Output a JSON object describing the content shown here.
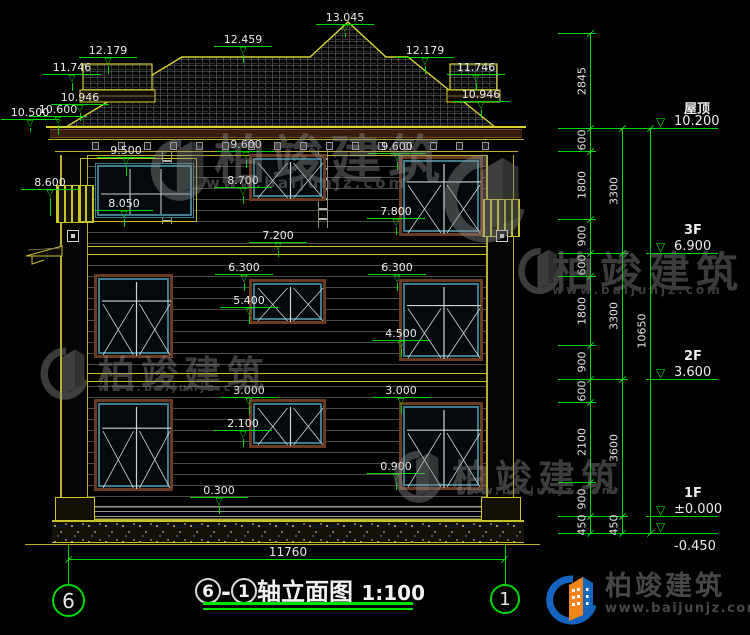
{
  "colors": {
    "dim_green": "#00d900",
    "outline_yellow": "#c9c32a",
    "window_teal": "#417c8e",
    "surround_brown": "#6b3a22",
    "logo_blue": "#1565c0",
    "logo_orange": "#f08519"
  },
  "watermark": {
    "name": "柏竣建筑",
    "url": "www.baijunjz.com"
  },
  "brand": {
    "name": "柏竣建筑",
    "url": "www.baijunjz.com"
  },
  "title_block": {
    "axis_start": "6",
    "axis_end": "1",
    "dash": "-",
    "title": "轴立面图",
    "scale": "1:100"
  },
  "bottom_dim": "11760",
  "annotations": [
    {
      "label": "13.045",
      "x": 345,
      "y": 12,
      "ld": 4
    },
    {
      "label": "12.459",
      "x": 243,
      "y": 34,
      "ld": 8
    },
    {
      "label": "12.179",
      "x": 108,
      "y": 45,
      "ld": 8
    },
    {
      "label": "11.746",
      "x": 72,
      "y": 62,
      "ld": 8
    },
    {
      "label": "10.946",
      "x": 80,
      "y": 92,
      "ld": 8
    },
    {
      "label": "10.500",
      "x": 30,
      "y": 107,
      "ld": 4
    },
    {
      "label": "10.600",
      "x": 58,
      "y": 104,
      "ld": 10
    },
    {
      "label": "12.179",
      "x": 425,
      "y": 45,
      "ld": 8
    },
    {
      "label": "11.746",
      "x": 476,
      "y": 62,
      "ld": 8
    },
    {
      "label": "10.946",
      "x": 481,
      "y": 89,
      "ld": 8
    },
    {
      "label": "9.500",
      "x": 126,
      "y": 145,
      "ld": 10
    },
    {
      "label": "9.600",
      "x": 246,
      "y": 139,
      "ld": 8
    },
    {
      "label": "9.600",
      "x": 397,
      "y": 141,
      "ld": 8
    },
    {
      "label": "8.600",
      "x": 50,
      "y": 177,
      "ld": 18
    },
    {
      "label": "8.700",
      "x": 243,
      "y": 175,
      "ld": 8
    },
    {
      "label": "8.050",
      "x": 124,
      "y": 198,
      "ld": 8
    },
    {
      "label": "7.800",
      "x": 396,
      "y": 206,
      "ld": 8
    },
    {
      "label": "7.200",
      "x": 278,
      "y": 230,
      "ld": 6
    },
    {
      "label": "6.300",
      "x": 244,
      "y": 262,
      "ld": 8
    },
    {
      "label": "6.300",
      "x": 397,
      "y": 262,
      "ld": 8
    },
    {
      "label": "5.400",
      "x": 249,
      "y": 295,
      "ld": 8
    },
    {
      "label": "4.500",
      "x": 401,
      "y": 328,
      "ld": 8
    },
    {
      "label": "3.000",
      "x": 249,
      "y": 385,
      "ld": 8
    },
    {
      "label": "3.000",
      "x": 401,
      "y": 385,
      "ld": 8
    },
    {
      "label": "2.100",
      "x": 243,
      "y": 418,
      "ld": 8
    },
    {
      "label": "0.900",
      "x": 396,
      "y": 461,
      "ld": 8
    },
    {
      "label": "0.300",
      "x": 219,
      "y": 485,
      "ld": 8
    }
  ],
  "right_dims": {
    "chain1": {
      "x": 590,
      "segments": [
        {
          "v": "2845",
          "y1": 33,
          "y2": 128
        },
        {
          "v": "600",
          "y1": 128,
          "y2": 151
        },
        {
          "v": "1800",
          "y1": 151,
          "y2": 219
        },
        {
          "v": "900",
          "y1": 219,
          "y2": 253
        },
        {
          "v": "600",
          "y1": 253,
          "y2": 276
        },
        {
          "v": "1800",
          "y1": 276,
          "y2": 345
        },
        {
          "v": "900",
          "y1": 345,
          "y2": 379
        },
        {
          "v": "600",
          "y1": 379,
          "y2": 402
        },
        {
          "v": "2100",
          "y1": 402,
          "y2": 482
        },
        {
          "v": "900",
          "y1": 482,
          "y2": 516
        },
        {
          "v": "450",
          "y1": 516,
          "y2": 533
        }
      ]
    },
    "chain2": {
      "x": 622,
      "segments": [
        {
          "v": "3300",
          "y1": 128,
          "y2": 253
        },
        {
          "v": "3300",
          "y1": 253,
          "y2": 379
        },
        {
          "v": "3600",
          "y1": 379,
          "y2": 516
        },
        {
          "v": "450",
          "y1": 516,
          "y2": 533
        }
      ]
    },
    "chain3": {
      "x": 650,
      "segments": [
        {
          "v": "10650",
          "y1": 128,
          "y2": 533
        }
      ]
    }
  },
  "levels": [
    {
      "name": "屋顶",
      "value": "10.200",
      "y": 128,
      "text_above": true
    },
    {
      "name": "3F",
      "value": "6.900",
      "y": 253,
      "text_above": true
    },
    {
      "name": "2F",
      "value": "3.600",
      "y": 379,
      "text_above": true
    },
    {
      "name": "1F",
      "value": "±0.000",
      "y": 516,
      "text_above": true
    },
    {
      "name": "",
      "value": "-0.450",
      "y": 533,
      "text_above": false
    }
  ]
}
